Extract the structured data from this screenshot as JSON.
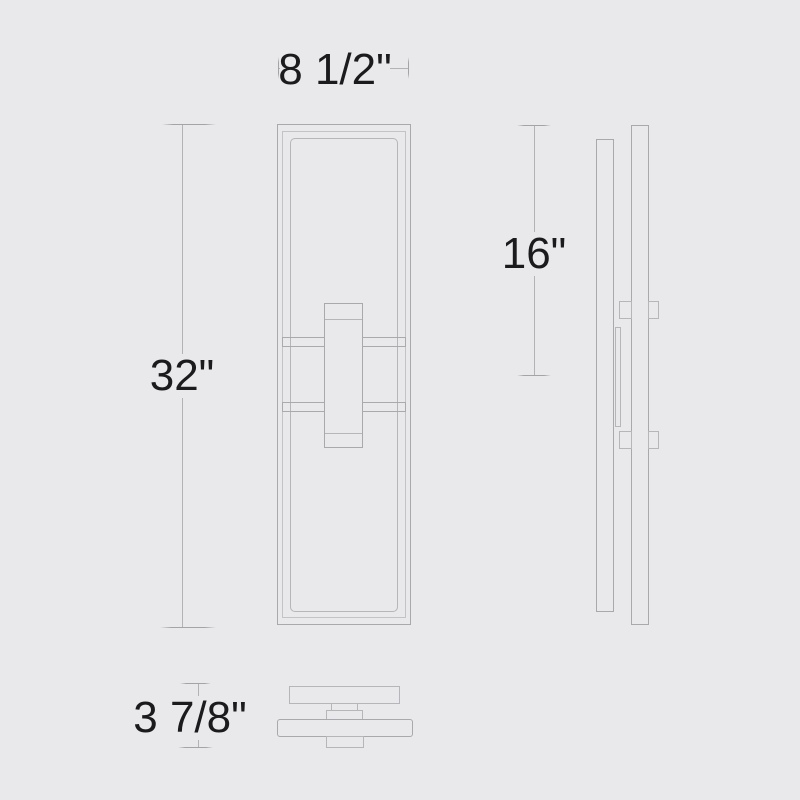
{
  "diagram": {
    "type": "product-dimension-drawing",
    "background_color": "#e9e9eb",
    "line_color": "#a8a8ad",
    "text_color": "#1b1b1d",
    "dim_labels": {
      "width": "8 1/2\"",
      "height": "32\"",
      "side_height": "16\"",
      "depth": "3 7/8\""
    },
    "views": {
      "front": "front elevation view",
      "side": "side profile view",
      "bottom": "bottom plan view"
    }
  }
}
